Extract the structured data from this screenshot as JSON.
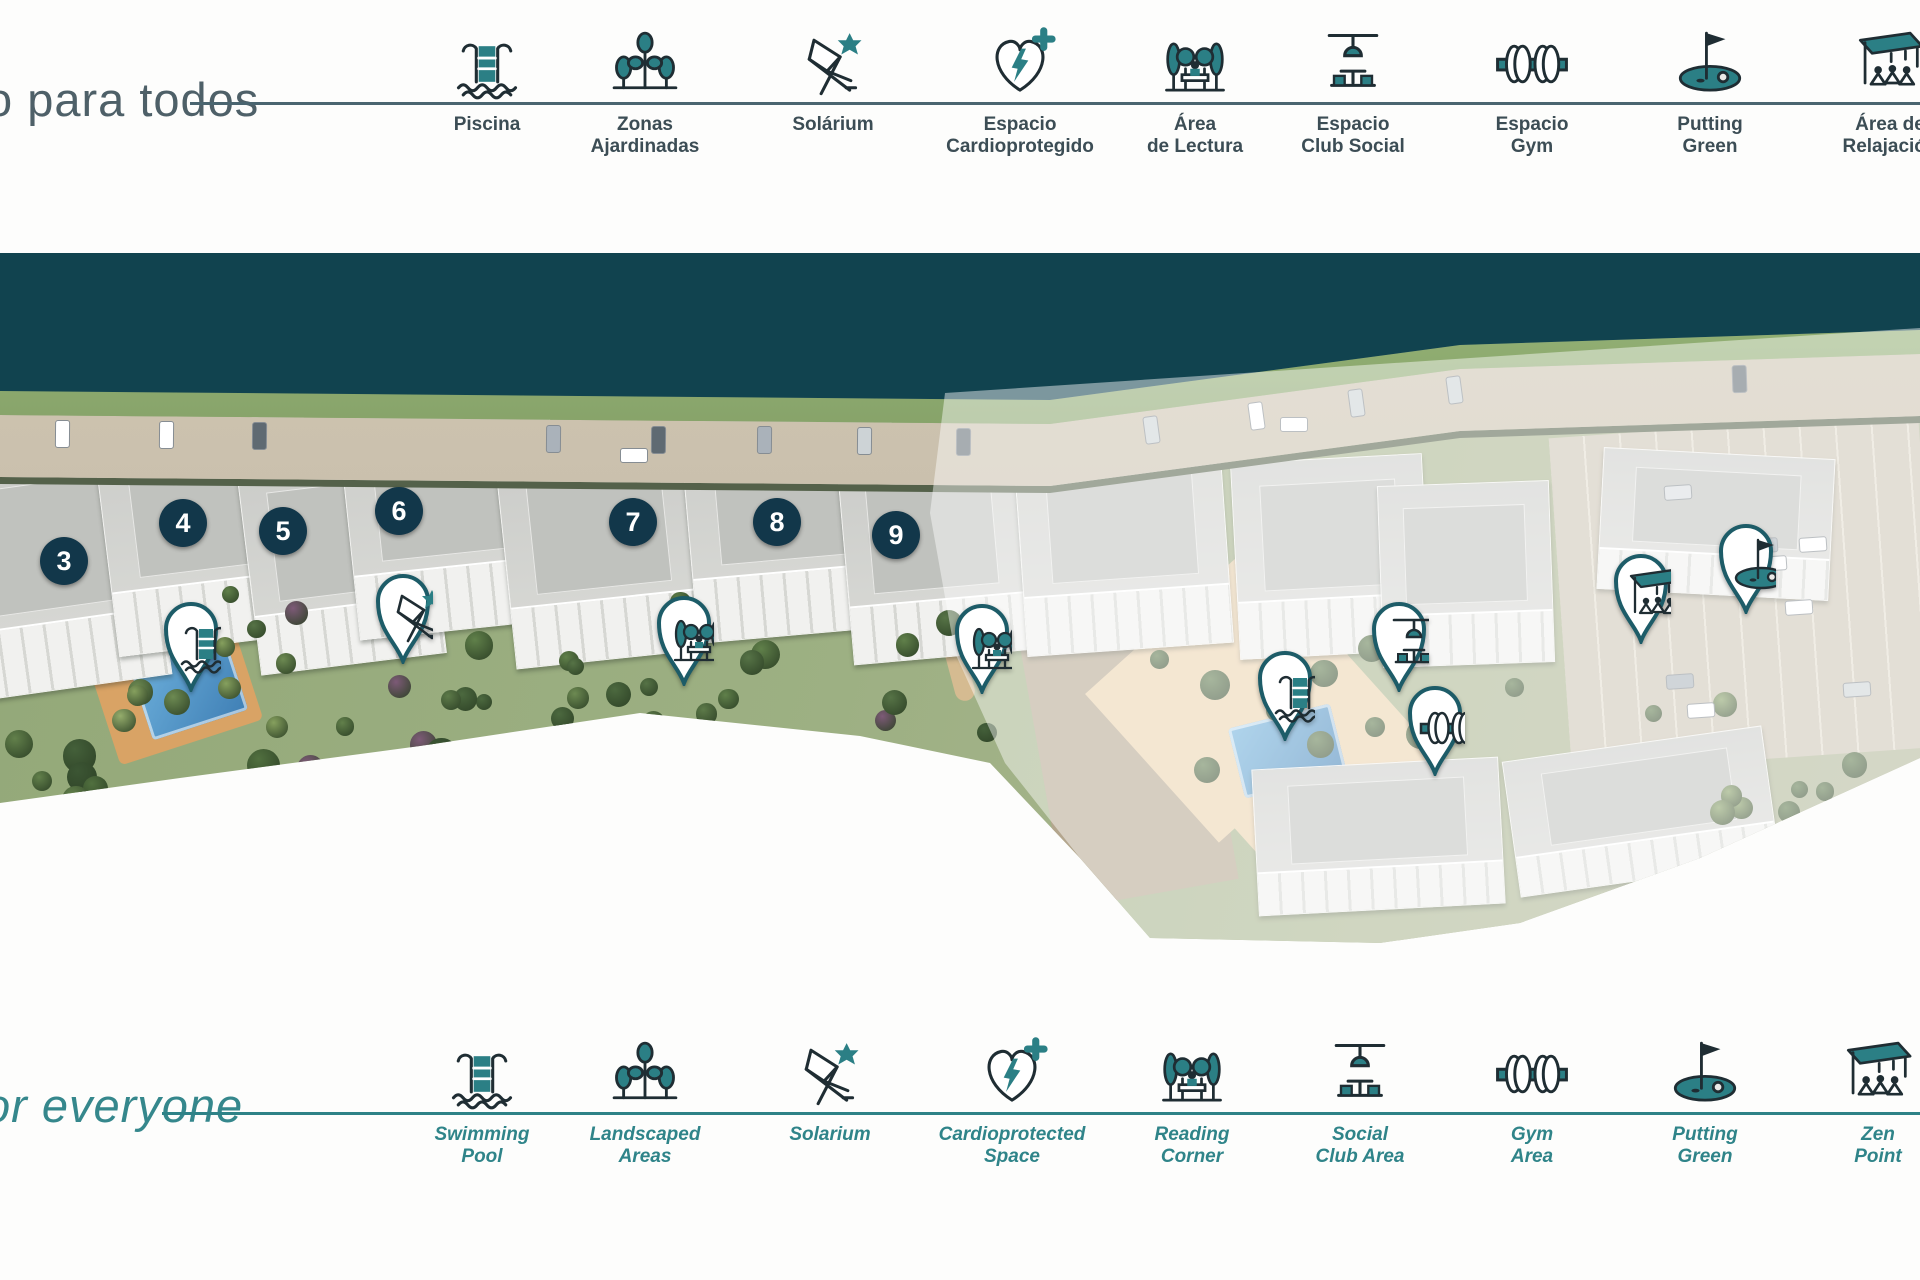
{
  "top_legend": {
    "heading": "o para todos",
    "items": [
      {
        "icon": "pool",
        "label": [
          "Piscina"
        ],
        "x": 487
      },
      {
        "icon": "trees",
        "label": [
          "Zonas",
          "Ajardinadas"
        ],
        "x": 645
      },
      {
        "icon": "solarium",
        "label": [
          "Solárium"
        ],
        "x": 833
      },
      {
        "icon": "cardio",
        "label": [
          "Espacio",
          "Cardioprotegido"
        ],
        "x": 1020
      },
      {
        "icon": "reading",
        "label": [
          "Área",
          "de Lectura"
        ],
        "x": 1195
      },
      {
        "icon": "social",
        "label": [
          "Espacio",
          "Club Social"
        ],
        "x": 1353
      },
      {
        "icon": "gym",
        "label": [
          "Espacio",
          "Gym"
        ],
        "x": 1532
      },
      {
        "icon": "putting",
        "label": [
          "Putting",
          "Green"
        ],
        "x": 1710
      },
      {
        "icon": "zen",
        "label": [
          "Área de",
          "Relajación"
        ],
        "x": 1890
      }
    ]
  },
  "bottom_legend": {
    "heading": "or everyone",
    "items": [
      {
        "icon": "pool",
        "label": [
          "Swimming",
          "Pool"
        ],
        "x": 482
      },
      {
        "icon": "trees",
        "label": [
          "Landscaped",
          "Areas"
        ],
        "x": 645
      },
      {
        "icon": "solarium",
        "label": [
          "Solarium"
        ],
        "x": 830
      },
      {
        "icon": "cardio",
        "label": [
          "Cardioprotected",
          "Space"
        ],
        "x": 1012
      },
      {
        "icon": "reading",
        "label": [
          "Reading",
          "Corner"
        ],
        "x": 1192
      },
      {
        "icon": "social",
        "label": [
          "Social",
          "Club Area"
        ],
        "x": 1360
      },
      {
        "icon": "gym",
        "label": [
          "Gym",
          "Area"
        ],
        "x": 1532
      },
      {
        "icon": "putting",
        "label": [
          "Putting",
          "Green"
        ],
        "x": 1705
      },
      {
        "icon": "zen",
        "label": [
          "Zen",
          "Point"
        ],
        "x": 1878
      }
    ]
  },
  "map": {
    "building_markers": [
      {
        "number": "3",
        "x": 64,
        "y": 561
      },
      {
        "number": "4",
        "x": 183,
        "y": 523
      },
      {
        "number": "5",
        "x": 283,
        "y": 531
      },
      {
        "number": "6",
        "x": 399,
        "y": 511
      },
      {
        "number": "7",
        "x": 633,
        "y": 522
      },
      {
        "number": "8",
        "x": 777,
        "y": 522
      },
      {
        "number": "9",
        "x": 896,
        "y": 535
      }
    ],
    "amenity_pins": [
      {
        "type": "swimming-pool",
        "x": 191,
        "y": 628
      },
      {
        "type": "solarium",
        "x": 403,
        "y": 600
      },
      {
        "type": "reading-corner",
        "x": 684,
        "y": 622
      },
      {
        "type": "reading-corner",
        "x": 982,
        "y": 630
      },
      {
        "type": "swimming-pool",
        "x": 1285,
        "y": 677
      },
      {
        "type": "social-club",
        "x": 1399,
        "y": 628
      },
      {
        "type": "gym",
        "x": 1435,
        "y": 712
      },
      {
        "type": "zen-point",
        "x": 1641,
        "y": 580
      },
      {
        "type": "putting-green",
        "x": 1746,
        "y": 550
      }
    ]
  },
  "colors": {
    "accent_teal": "#2b7f85",
    "icon_outline": "#1f2d33",
    "sea_band": "#11434f",
    "badge_bg": "#12374a",
    "pin_border": "#1d5c68",
    "top_label": "#3c4d55",
    "bottom_label": "#2f8489"
  }
}
